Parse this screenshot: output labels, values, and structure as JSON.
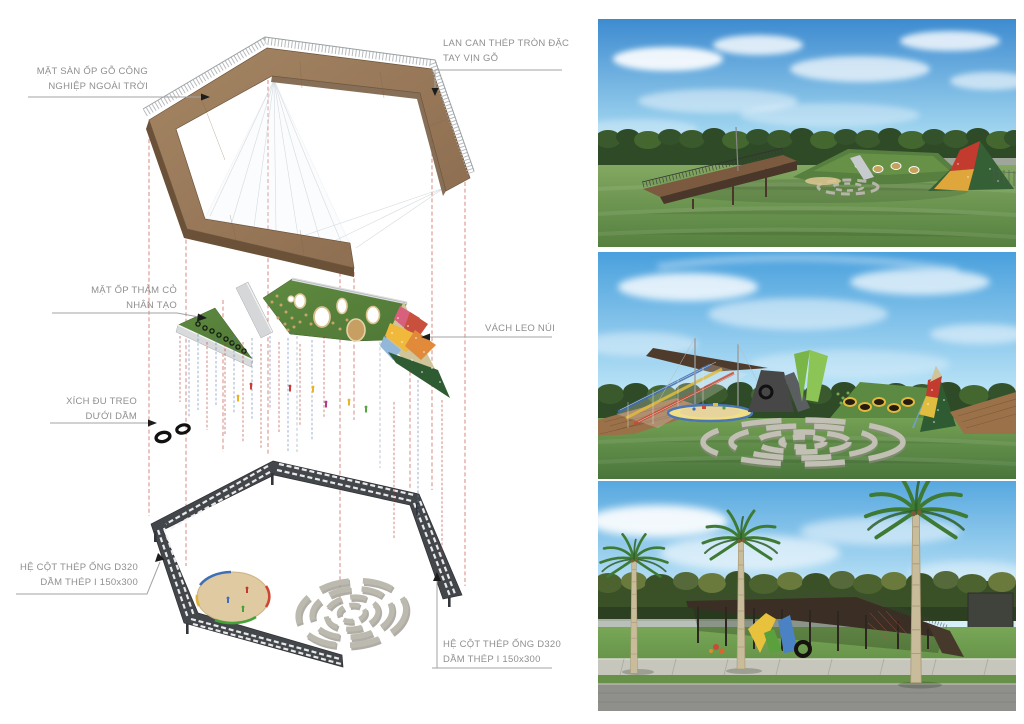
{
  "diagram": {
    "labels": {
      "deck_surface": {
        "line1": "MẶT SÀN ỐP GỖ CÔNG",
        "line2": "NGHIỆP NGOÀI TRỜI"
      },
      "railing": {
        "line1": "LAN CAN THÉP TRÒN ĐẶC",
        "line2": "TAY VỊN GỖ"
      },
      "turf": {
        "line1": "MẶT ỐP THẢM CỎ",
        "line2": "NHÂN TẠO"
      },
      "climbing_wall": {
        "line1": "VÁCH LEO NÚI"
      },
      "swing": {
        "line1": "XÍCH ĐU TREO",
        "line2": "DƯỚI DẦM"
      },
      "structure_left": {
        "line1": "HỆ CỘT THÉP ỐNG D320",
        "line2": "DẦM THÉP I 150x300"
      },
      "structure_right": {
        "line1": "HỆ CỘT THÉP ỐNG D320",
        "line2": "DẦM THÉP I 150x300"
      }
    },
    "palette": {
      "wood": "#96775a",
      "wood_dark": "#6b5138",
      "turf_green": "#57813b",
      "turf_dark": "#2f5b33",
      "truss_steel": "#43464a",
      "sand": "#dfcaa1",
      "stone": "#b2afa5",
      "projection_red": "#c0392b",
      "projection_blue": "#5b7fb5",
      "label_text": "#8f8f8f",
      "leader_line": "#a3a3a3",
      "climb_pink": "#d8607c",
      "climb_yellow": "#f0b93c",
      "climb_blue": "#92b7d8",
      "climb_khaki": "#cfc49a",
      "sky": "#4a97d8",
      "tree": "#2e4a26",
      "grass": "#74994f",
      "road": "#8f908c",
      "sidewalk": "#c6c6bd",
      "palm_frond": "#3e7a33",
      "palm_trunk": "#c9bc9b"
    }
  }
}
